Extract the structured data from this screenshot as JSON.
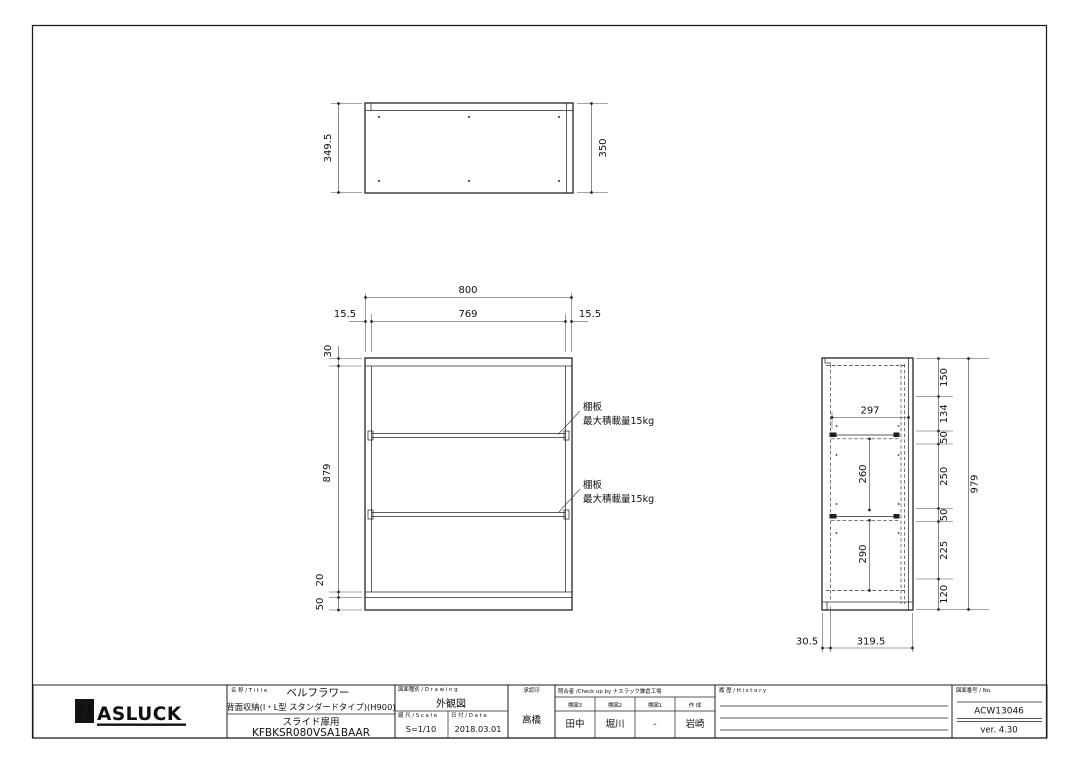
{
  "page": {
    "background": "#ffffff",
    "line_color": "#1f1f1f"
  },
  "views": {
    "top": {
      "dim_left": "349.5",
      "dim_right": "350"
    },
    "front": {
      "dim_width": "800",
      "dim_inner_width": "769",
      "dim_offset_left": "15.5",
      "dim_offset_right": "15.5",
      "dim_top_panel": "30",
      "dim_interior": "879",
      "dim_bottom_panel": "20",
      "dim_base": "50",
      "shelf_notes": [
        {
          "label": "棚板",
          "load": "最大積載量15kg"
        },
        {
          "label": "棚板",
          "load": "最大積載量15kg"
        }
      ]
    },
    "side": {
      "chain": [
        "150",
        "134",
        "50",
        "250",
        "50",
        "225",
        "120"
      ],
      "dim_total": "979",
      "dim_inner_width": "297",
      "dim_upper_gap": "260",
      "dim_lower_gap": "290",
      "dim_bottom_front": "30.5",
      "dim_bottom_back": "319.5"
    }
  },
  "title_block": {
    "logo": {
      "n": "N",
      "rest": "ASLUCK"
    },
    "title_label": "名 称 / T i t l e",
    "title_line1": "ベルフラワー",
    "title_line2": "背面収納(I・L型 スタンダードタイプ)(H900)",
    "title_line3": "スライド扉用",
    "title_line4": "KFBKSR080VSA1BAAR",
    "drawing_label": "図面種別 / D r a w i n g",
    "drawing_value": "外観図",
    "scale_label": "縮 尺 / S c a l e",
    "scale_value": "S=1/10",
    "date_label": "日 付 / D a t e",
    "date_value": "2018.03.01",
    "approval_label": "承認印",
    "approval_value": "高橋",
    "check_label": "照合者 /Check up by ナスラック鎌倉工場",
    "check_columns": [
      {
        "label": "検図3",
        "value": "田中"
      },
      {
        "label": "検図2",
        "value": "堀川"
      },
      {
        "label": "検図1",
        "value": "-"
      },
      {
        "label": "作 成",
        "value": "岩崎"
      }
    ],
    "history_label": "履 歴 / H i s t o r y",
    "no_label": "図面番号 / No.",
    "no_value": "ACW13046",
    "version": "ver. 4.30"
  }
}
